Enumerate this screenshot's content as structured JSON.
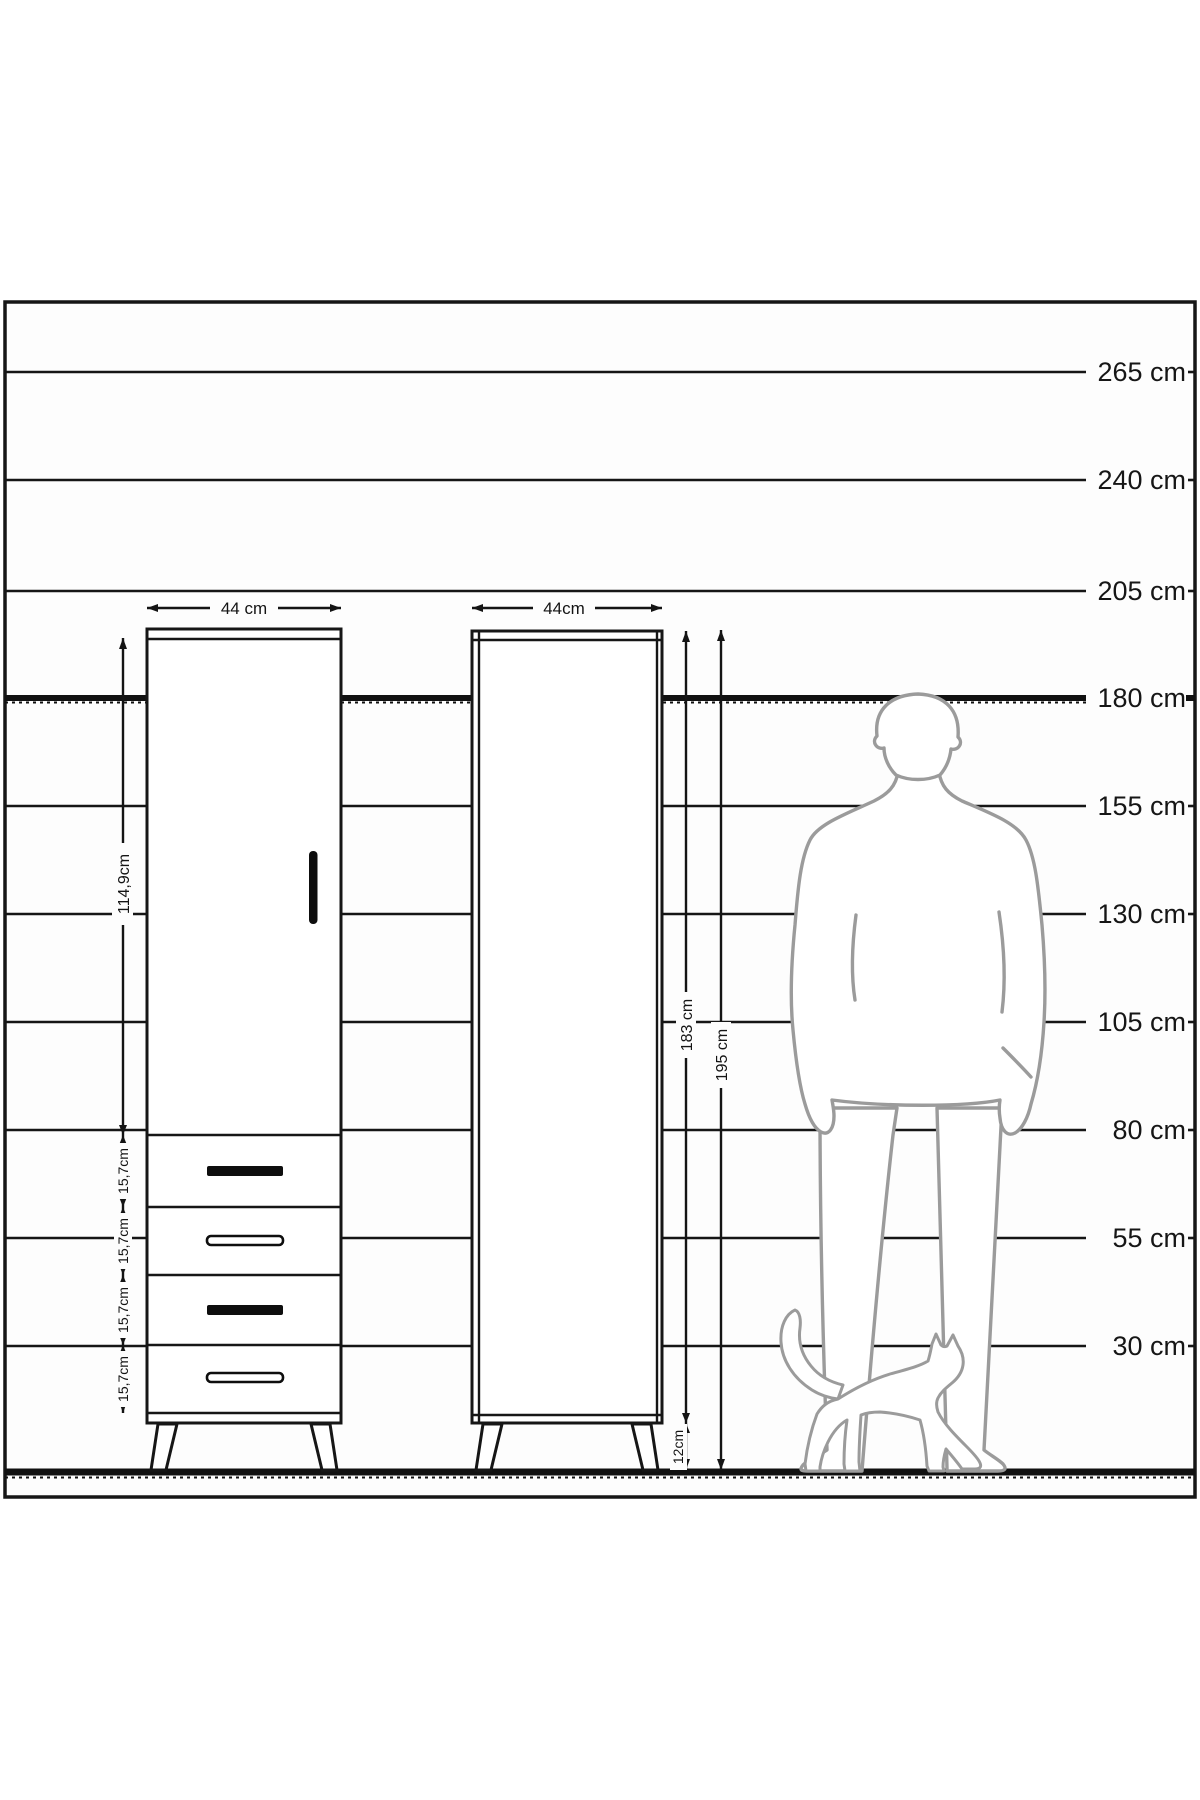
{
  "diagram_title": "wardrobe-height-scale-diagram",
  "scale": {
    "unit": "cm",
    "labels": [
      "265 cm",
      "240 cm",
      "205 cm",
      "180 cm",
      "155 cm",
      "130 cm",
      "105 cm",
      "80 cm",
      "55 cm",
      "30 cm"
    ]
  },
  "cabinet_front": {
    "width_label": "44 cm",
    "door_height_label": "114,9cm",
    "drawer_labels": [
      "15,7cm",
      "15,7cm",
      "15,7cm",
      "15,7cm"
    ]
  },
  "cabinet_side": {
    "width_label": "44cm",
    "body_height_label": "183 cm",
    "total_height_label": "195 cm",
    "leg_height_label": "12cm"
  },
  "figures": {
    "man": "man-silhouette",
    "cat": "cat-silhouette"
  },
  "colors": {
    "line": "#161616",
    "silhouette": "#9b9b9b",
    "frame_fill": "#fdfdfd",
    "background": "#ffffff"
  }
}
